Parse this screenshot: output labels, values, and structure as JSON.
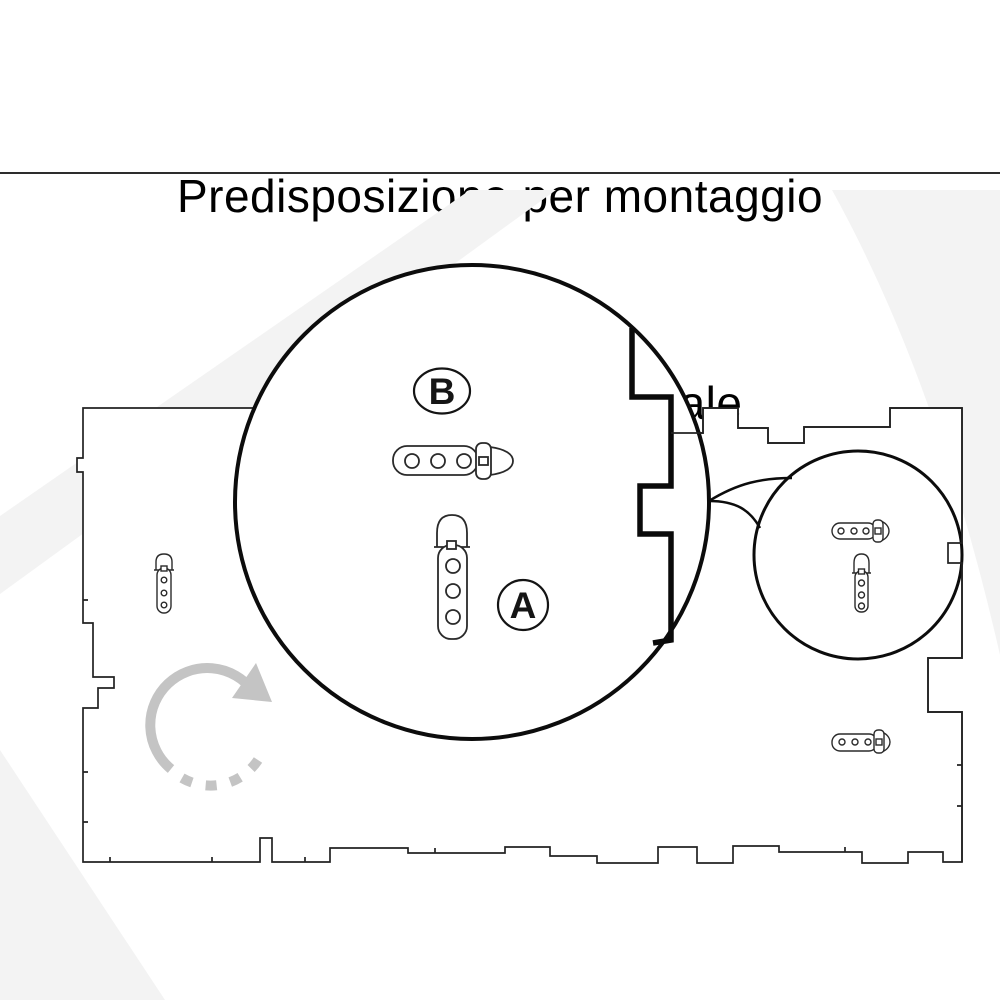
{
  "title": {
    "line1": "Predisposizione per montaggio",
    "line2": "Verticale  o Orizzontale"
  },
  "callouts": {
    "label_a": "A",
    "label_b": "B"
  },
  "colors": {
    "background": "#ffffff",
    "line": "#222222",
    "circle_stroke": "#0c0c0c",
    "arrow_gray": "#c4c4c4",
    "watermark_gray": "#f3f3f3",
    "label_text": "#151515"
  },
  "icons": {
    "zoom_large": "magnifier-circle-large",
    "zoom_small": "magnifier-circle-small",
    "rotation_arrow": "clockwise-rotation-arrow-icon"
  },
  "diagram": {
    "panel": "laser-cut-panel-outline",
    "straps": [
      "panel-strap-vertical-left",
      "panel-strap-horizontal-right",
      "zoomed-strap-horizontal-b",
      "zoomed-strap-vertical-a",
      "small-zoom-strap-horizontal",
      "small-zoom-strap-vertical"
    ]
  }
}
